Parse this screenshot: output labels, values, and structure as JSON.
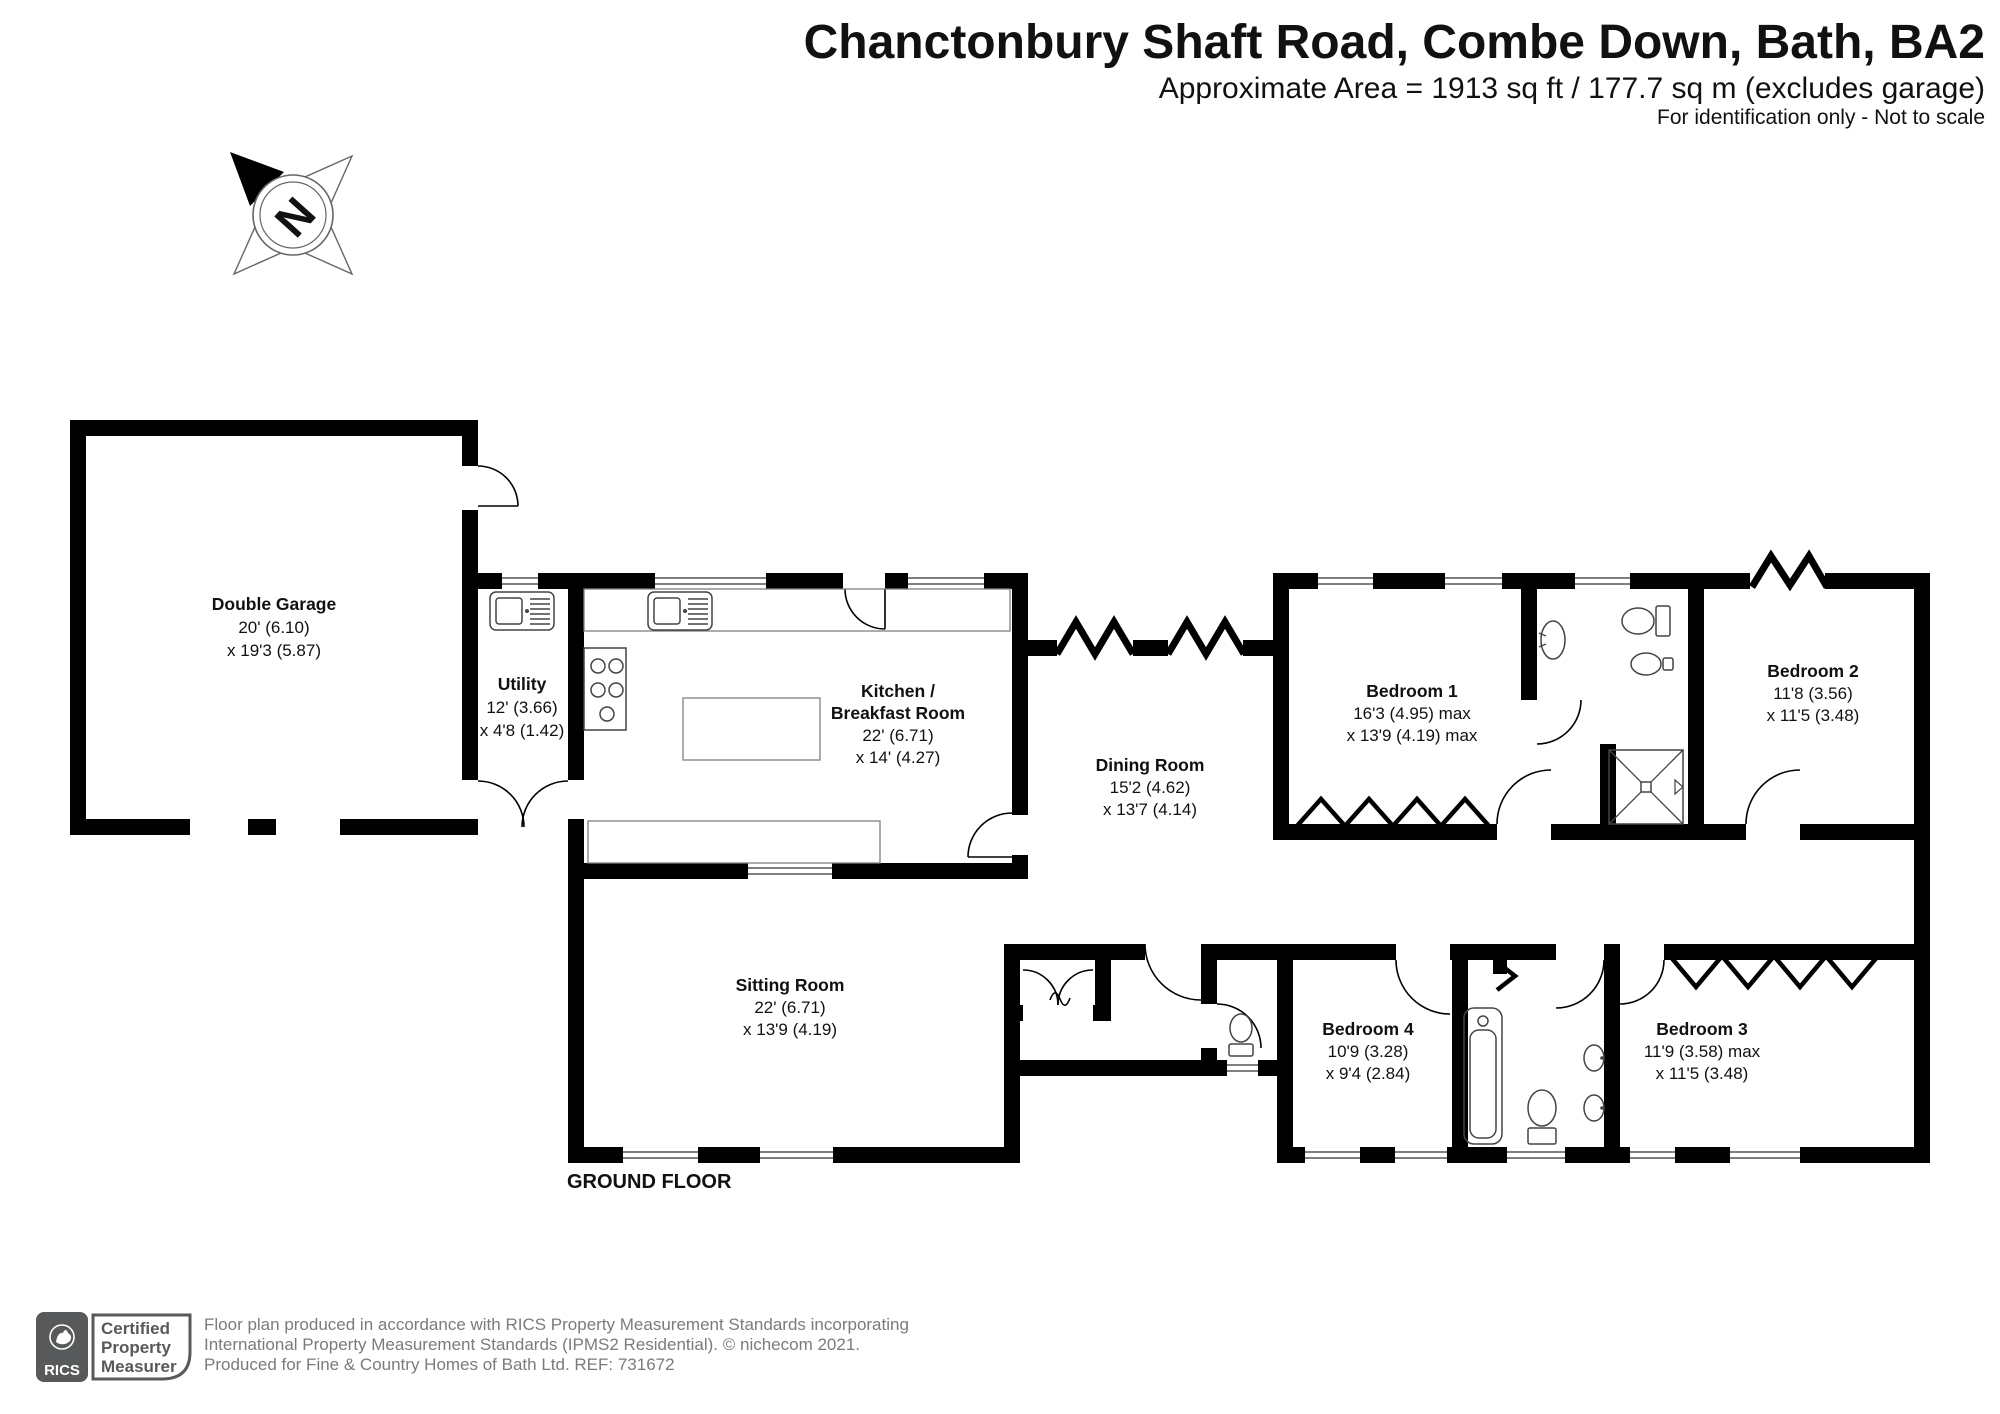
{
  "header": {
    "title": "Chanctonbury Shaft Road, Combe Down, Bath, BA2",
    "area_line": "Approximate Area = 1913 sq ft / 177.7 sq m (excludes garage)",
    "note_line": "For identification only - Not to scale"
  },
  "compass": {
    "north_label": "N"
  },
  "floor_label": "GROUND FLOOR",
  "rooms": {
    "garage": {
      "name": "Double Garage",
      "dim1": "20' (6.10)",
      "dim2": "x 19'3 (5.87)"
    },
    "utility": {
      "name": "Utility",
      "dim1": "12' (3.66)",
      "dim2": "x 4'8 (1.42)"
    },
    "kitchen": {
      "name1": "Kitchen /",
      "name2": "Breakfast Room",
      "dim1": "22' (6.71)",
      "dim2": "x 14' (4.27)"
    },
    "dining": {
      "name": "Dining Room",
      "dim1": "15'2 (4.62)",
      "dim2": "x 13'7 (4.14)"
    },
    "sitting": {
      "name": "Sitting Room",
      "dim1": "22' (6.71)",
      "dim2": "x 13'9 (4.19)"
    },
    "bedroom1": {
      "name": "Bedroom 1",
      "dim1": "16'3 (4.95) max",
      "dim2": "x 13'9 (4.19) max"
    },
    "bedroom2": {
      "name": "Bedroom 2",
      "dim1": "11'8 (3.56)",
      "dim2": "x 11'5 (3.48)"
    },
    "bedroom3": {
      "name": "Bedroom 3",
      "dim1": "11'9 (3.58) max",
      "dim2": "x 11'5 (3.48)"
    },
    "bedroom4": {
      "name": "Bedroom 4",
      "dim1": "10'9 (3.28)",
      "dim2": "x 9'4 (2.84)"
    }
  },
  "footer": {
    "line1": "Floor plan produced in accordance with RICS Property Measurement Standards incorporating",
    "line2": "International Property Measurement Standards (IPMS2 Residential).   © nichecom 2021.",
    "line3": "Produced for Fine & Country Homes of Bath Ltd.   REF:  731672",
    "rics_brand": "RICS",
    "cert1": "Certified",
    "cert2": "Property",
    "cert3": "Measurer"
  },
  "icons": {
    "compass": "4-point star compass rose with rotated N",
    "rics_logo": "dark grey rounded square with white lion mark"
  },
  "colors": {
    "wall": "#000000",
    "fixture_stroke": "#444444",
    "footer_text": "#7b7b7b",
    "rics_grey": "#58595B"
  }
}
